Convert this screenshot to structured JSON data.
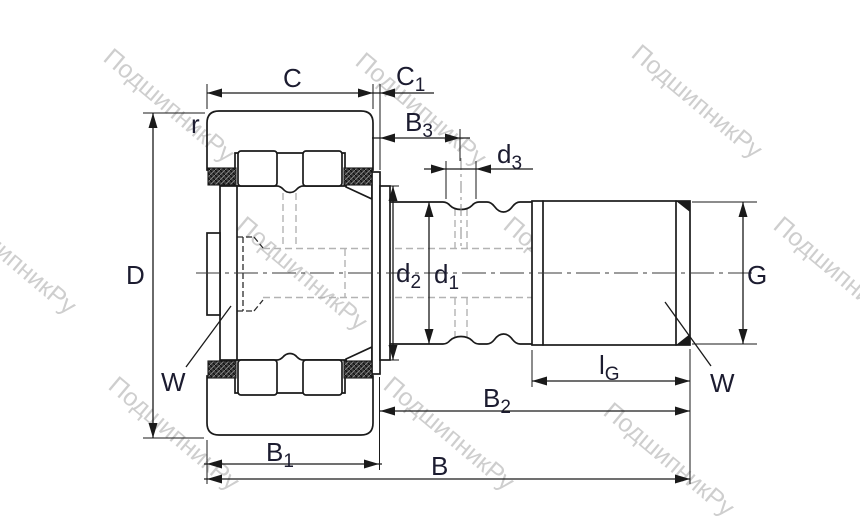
{
  "watermark": {
    "text": "ПодшипникРу",
    "color_hex": "#c8c8c8"
  },
  "colors": {
    "line": "#1a1a1a",
    "label": "#1c1c30",
    "hidden": "#b3b3b3",
    "dashdark": "#2b2b2b",
    "watermark": "#c8c8c8",
    "bg": "#ffffff"
  },
  "labels": {
    "C": {
      "main": "C",
      "sub": ""
    },
    "C1": {
      "main": "C",
      "sub": "1"
    },
    "B3": {
      "main": "B",
      "sub": "3"
    },
    "d3": {
      "main": "d",
      "sub": "3"
    },
    "r": {
      "main": "r",
      "sub": ""
    },
    "D": {
      "main": "D",
      "sub": ""
    },
    "d2": {
      "main": "d",
      "sub": "2"
    },
    "d1": {
      "main": "d",
      "sub": "1"
    },
    "G": {
      "main": "G",
      "sub": ""
    },
    "W_left": {
      "main": "W",
      "sub": ""
    },
    "W_right": {
      "main": "W",
      "sub": ""
    },
    "lG": {
      "main": "l",
      "sub": "G"
    },
    "B2": {
      "main": "B",
      "sub": "2"
    },
    "B1": {
      "main": "B",
      "sub": "1"
    },
    "B": {
      "main": "B",
      "sub": ""
    }
  }
}
